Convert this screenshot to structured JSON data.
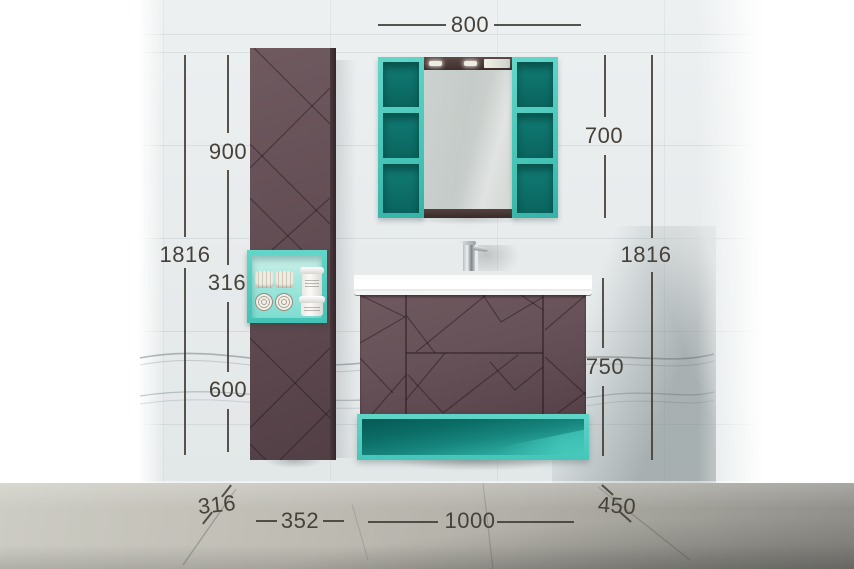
{
  "dimensions_mm": {
    "top_width": "800",
    "left_upper": "900",
    "left_total": "1816",
    "left_box": "316",
    "left_lower": "600",
    "right_mirror_height": "700",
    "right_total": "1816",
    "right_vanity_height": "750",
    "floor_left_depth": "316",
    "floor_left_width": "352",
    "floor_center_width": "1000",
    "floor_right_depth": "450"
  },
  "colors": {
    "accent_teal": "#4ecbbe",
    "teal_interior_dark": "#0b6d66",
    "cabinet_plum": "#624e54",
    "dimension_ink": "#46423a",
    "wall": "#e9edee",
    "floor": "#b1afa7"
  }
}
